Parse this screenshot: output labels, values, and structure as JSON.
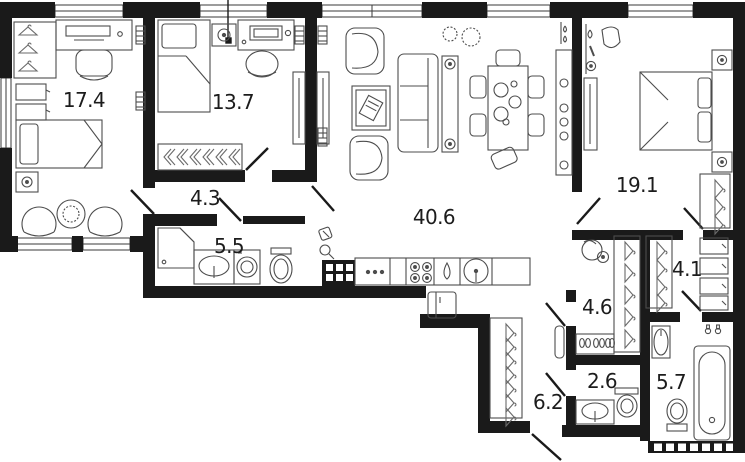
{
  "floorplan": {
    "type": "apartment-floor-plan",
    "rooms": [
      {
        "name": "bedroom-left",
        "area": "17.4"
      },
      {
        "name": "bedroom-middle",
        "area": "13.7"
      },
      {
        "name": "corridor",
        "area": "4.3"
      },
      {
        "name": "bathroom-family",
        "area": "5.5"
      },
      {
        "name": "living-kitchen",
        "area": "40.6"
      },
      {
        "name": "bedroom-master",
        "area": "19.1"
      },
      {
        "name": "wardrobe-master",
        "area": "4.1"
      },
      {
        "name": "storage-closet",
        "area": "4.6"
      },
      {
        "name": "wc-guest",
        "area": "2.6"
      },
      {
        "name": "bathroom-master",
        "area": "5.7"
      },
      {
        "name": "entry-hall",
        "area": "6.2"
      }
    ],
    "colors": {
      "wall": "#1a1a1a",
      "furniture": "#4d4d4d",
      "background": "#ffffff"
    }
  }
}
